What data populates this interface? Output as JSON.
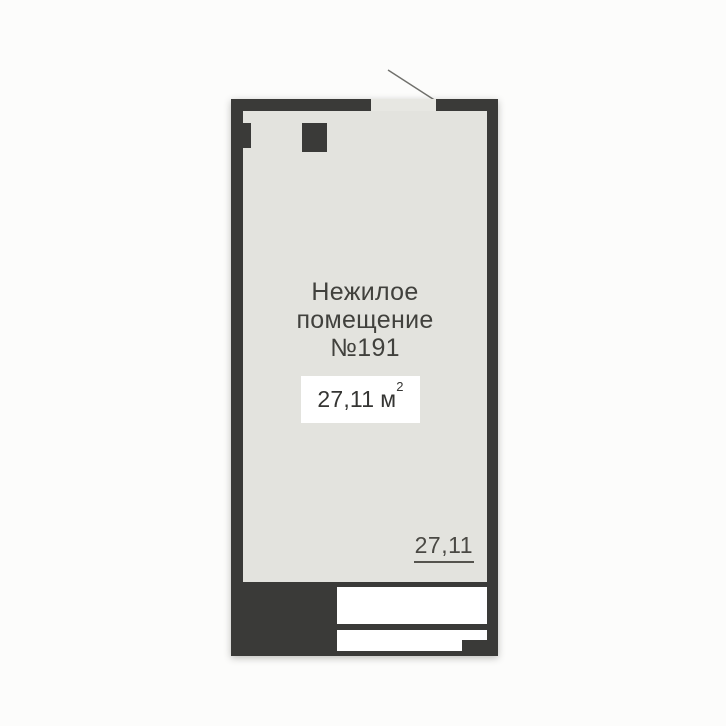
{
  "colors": {
    "bg": "#fcfcfb",
    "wall": "#3a3a38",
    "interior": "#e3e3de",
    "opening": "#e7e7e2",
    "white": "#ffffff",
    "text": "#41413d",
    "door-line": "#70706c"
  },
  "floorplan": {
    "room_title": {
      "line1": "Нежилое",
      "line2": "помещение",
      "line3": "№191"
    },
    "area": {
      "value": "27,11",
      "unit": "м",
      "exponent": "2"
    },
    "dimension_label": "27,11"
  }
}
